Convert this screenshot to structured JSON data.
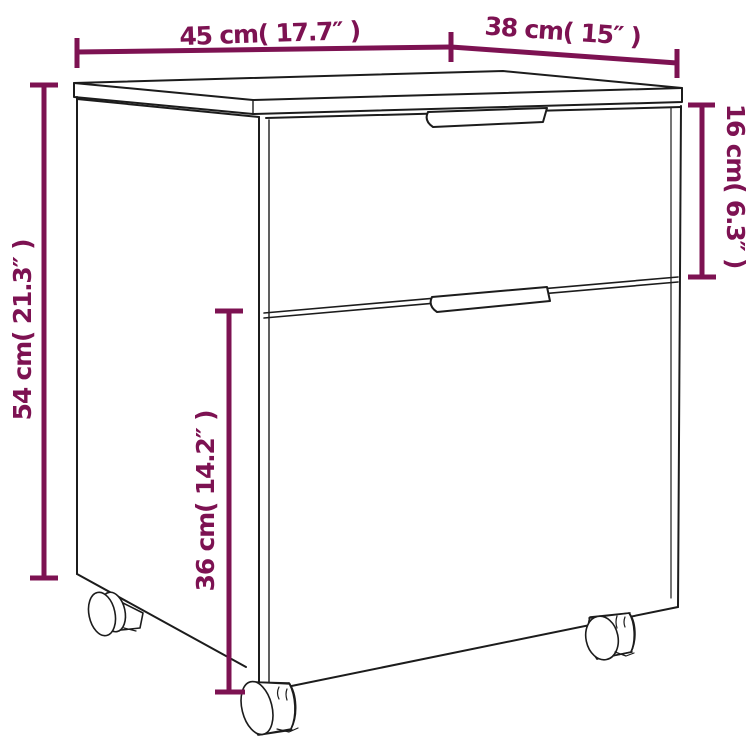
{
  "diagram": {
    "type": "product-dimension-drawing",
    "subject": "mobile 2-drawer file cabinet with casters",
    "colors": {
      "dimension": "#7d1252",
      "outline": "#1c1c1c",
      "background": "#ffffff"
    },
    "dimensions": {
      "width": {
        "label": "45 cm( 17.7″ )",
        "value_cm": 45,
        "value_in": 17.7,
        "orientation": "horizontal-top-left"
      },
      "depth": {
        "label": "38 cm( 15″ )",
        "value_cm": 38,
        "value_in": 15,
        "orientation": "horizontal-top-right"
      },
      "height": {
        "label": "54 cm( 21.3″ )",
        "value_cm": 54,
        "value_in": 21.3,
        "orientation": "vertical-left"
      },
      "top_drawer": {
        "label": "16 cm( 6.3″ )",
        "value_cm": 16,
        "value_in": 6.3,
        "orientation": "vertical-right"
      },
      "bottom_drawer": {
        "label": "36 cm( 14.2″ )",
        "value_cm": 36,
        "value_in": 14.2,
        "orientation": "vertical-inner"
      }
    }
  }
}
